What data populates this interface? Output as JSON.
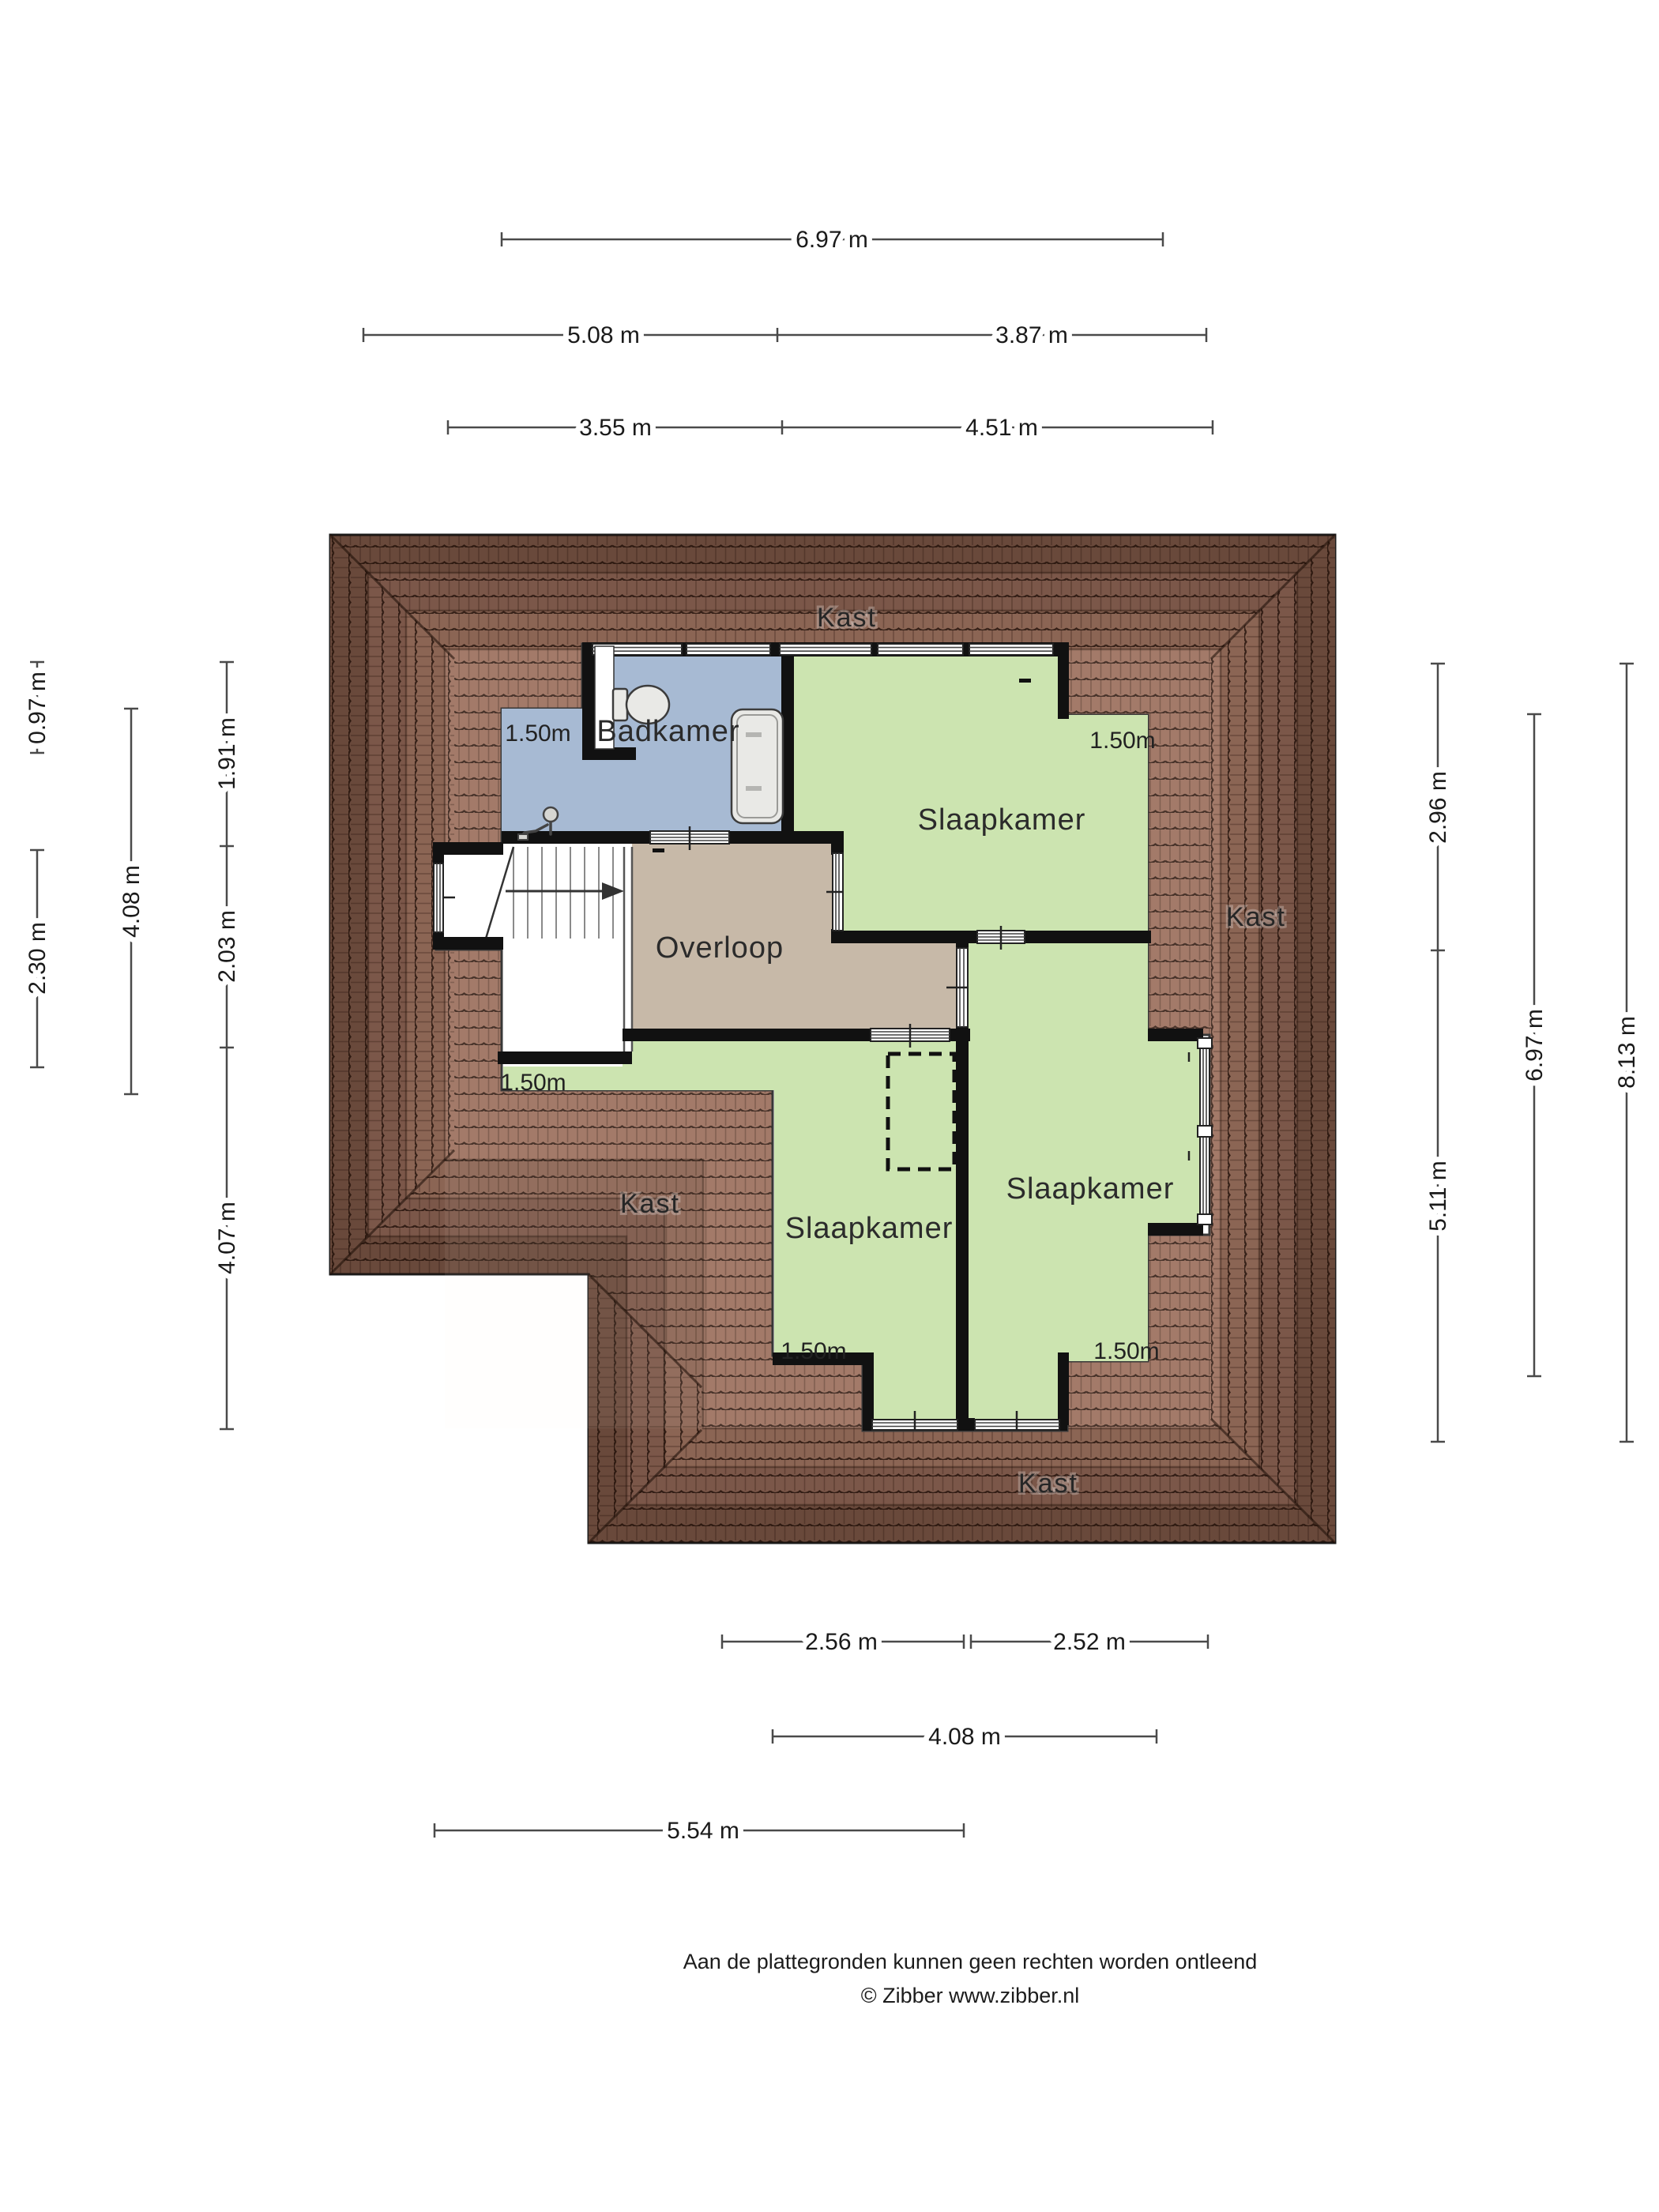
{
  "title": "Zolder plattegrond",
  "rooms": {
    "badkamer": "Badkamer",
    "slaapkamer_top": "Slaapkamer",
    "slaapkamer_bottom_left": "Slaapkamer",
    "slaapkamer_bottom_right": "Slaapkamer",
    "overloop": "Overloop"
  },
  "kast": {
    "top": "Kast",
    "right": "Kast",
    "left": "Kast",
    "bottom": "Kast"
  },
  "knee_heights": {
    "bathroom": "1.50m",
    "bedroom_top_right": "1.50m",
    "under_stairs": "1.50m",
    "bedroom_bottom_left": "1.50m",
    "bedroom_bottom_right": "1.50m"
  },
  "dims": {
    "top_row1": "6.97 m",
    "top_row2_left": "5.08 m",
    "top_row2_right": "3.87 m",
    "top_row3_left": "3.55 m",
    "top_row3_right": "4.51 m",
    "left_col1_top": "0.97 m",
    "left_col1_bottom": "2.30 m",
    "left_col2": "4.08 m",
    "left_col3_top": "1.91 m",
    "left_col3_mid": "2.03 m",
    "left_col3_bottom": "4.07 m",
    "right_col1_top": "2.96 m",
    "right_col1_bottom": "5.11 m",
    "right_col2": "6.97 m",
    "right_col3": "8.13 m",
    "bottom_row1_left": "2.56 m",
    "bottom_row1_right": "2.52 m",
    "bottom_row2": "4.08 m",
    "bottom_row3": "5.54 m"
  },
  "footer": {
    "disclaimer": "Aan de plattegronden kunnen geen rechten worden ontleend",
    "copyright": "© Zibber www.zibber.nl"
  },
  "colors": {
    "roof_base": "#9c7260",
    "roof_shadow": "#55352a",
    "room_green": "#cce4b0",
    "room_blue": "#a7bad3",
    "room_tan": "#c7b9a8",
    "interior_white": "#ffffff",
    "wall": "#111111"
  }
}
